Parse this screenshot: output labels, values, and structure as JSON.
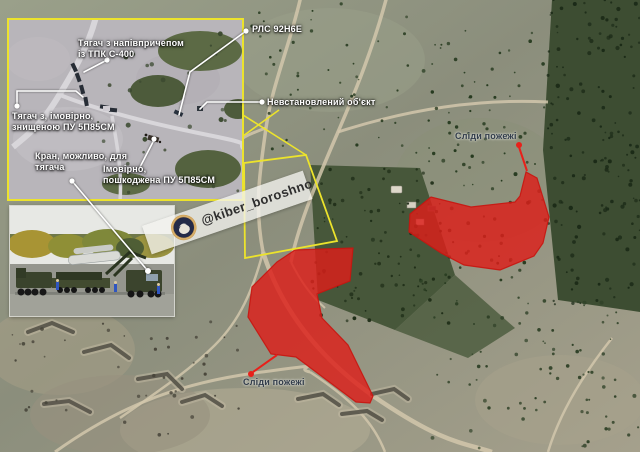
{
  "annotations": {
    "inset_labels": [
      {
        "id": "truck-s400",
        "text": "Тягач з напівпричепом\nіз ТПК С-400"
      },
      {
        "id": "truck-destroyed",
        "text": "Тягач з, імовірно,\nзнищеною ПУ 5П85СМ"
      },
      {
        "id": "crane",
        "text": "Кран, можливо, для\nтягача"
      },
      {
        "id": "damaged-pu",
        "text": "Імовірно,\nпошкоджена ПУ 5П85СМ"
      }
    ],
    "map_labels": [
      {
        "id": "radar",
        "text": "РЛС 92Н6Е"
      },
      {
        "id": "unknown-object",
        "text": "Невстановлений об'єкт"
      }
    ],
    "fire_labels": [
      {
        "id": "fire-right",
        "text": "Сліди пожежі"
      },
      {
        "id": "fire-left",
        "text": "Сліди пожежі"
      }
    ]
  },
  "watermark": {
    "handle": "@kiber_boroshno",
    "logo": "kiber-boroshno-badge"
  },
  "colors": {
    "annotation_yellow": "#ece32c",
    "fire_red": "#dd1f1a",
    "leader_white": "#ffffff",
    "label_dark": "#323d4b"
  }
}
